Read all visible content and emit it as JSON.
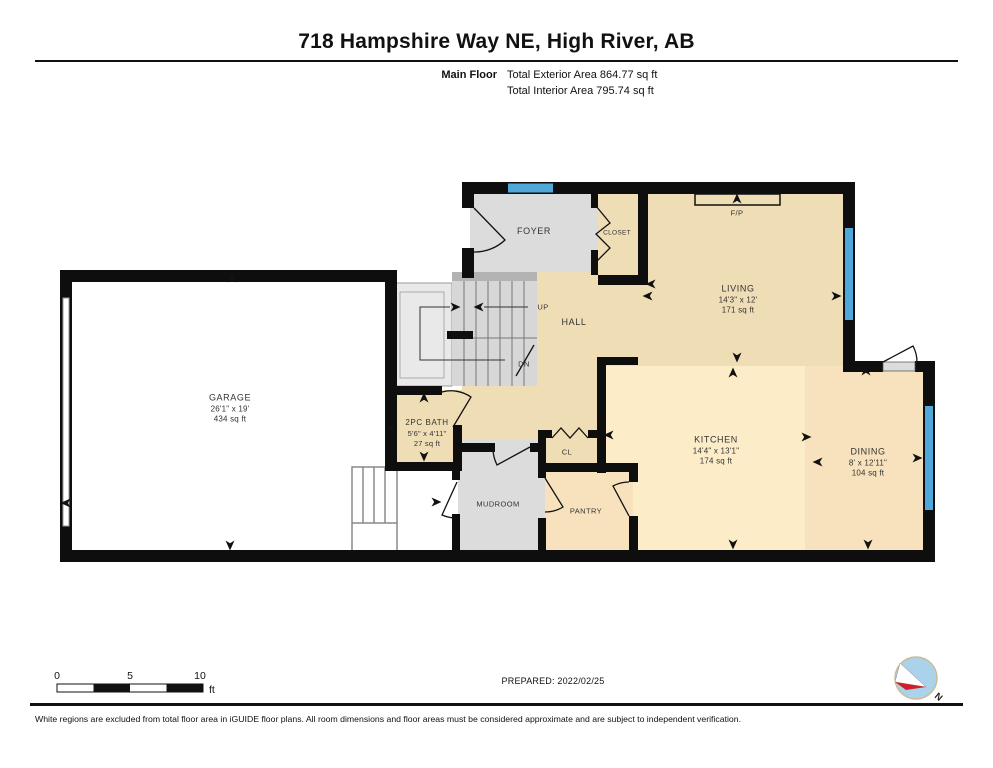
{
  "header": {
    "title": "718 Hampshire Way NE, High River, AB",
    "floor_label": "Main Floor",
    "exterior_area": "Total Exterior Area 864.77 sq ft",
    "interior_area": "Total Interior Area 795.74 sq ft"
  },
  "rooms": {
    "foyer": {
      "name": "FOYER"
    },
    "closet": {
      "name": "CLOSET"
    },
    "fireplace": {
      "name": "F/P"
    },
    "living": {
      "name": "LIVING",
      "dims": "14'3\" x 12'",
      "area": "171 sq ft"
    },
    "hall": {
      "name": "HALL"
    },
    "stairs": {
      "up": "UP",
      "down": "DN"
    },
    "garage": {
      "name": "GARAGE",
      "dims": "26'1\" x 19'",
      "area": "434 sq ft"
    },
    "bath": {
      "name": "2PC BATH",
      "dims": "5'6\" x 4'11\"",
      "area": "27 sq ft"
    },
    "mudroom": {
      "name": "MUDROOM"
    },
    "cl": {
      "name": "CL"
    },
    "pantry": {
      "name": "PANTRY"
    },
    "kitchen": {
      "name": "KITCHEN",
      "dims": "14'4\" x 13'1\"",
      "area": "174 sq ft"
    },
    "dining": {
      "name": "DINING",
      "dims": "8' x 12'11\"",
      "area": "104 sq ft"
    }
  },
  "scale_bar": {
    "tick0": "0",
    "tick5": "5",
    "tick10": "10",
    "unit": "ft"
  },
  "prepared": "PREPARED: 2022/02/25",
  "compass": {
    "north_label": "N"
  },
  "footer": "White regions are excluded from total floor area in iGUIDE floor plans. All room dimensions and floor areas must be considered approximate and are subject to independent verification.",
  "colors": {
    "wall": "#0e0e0e",
    "window_blue": "#4fa8d8",
    "floor_tan": "#efddb6",
    "floor_kitchen": "#fcedc8",
    "floor_dining": "#f8e2bd",
    "floor_gray": "#dcdcdc",
    "compass_blue": "#aad2ea",
    "compass_red": "#cf2027"
  }
}
